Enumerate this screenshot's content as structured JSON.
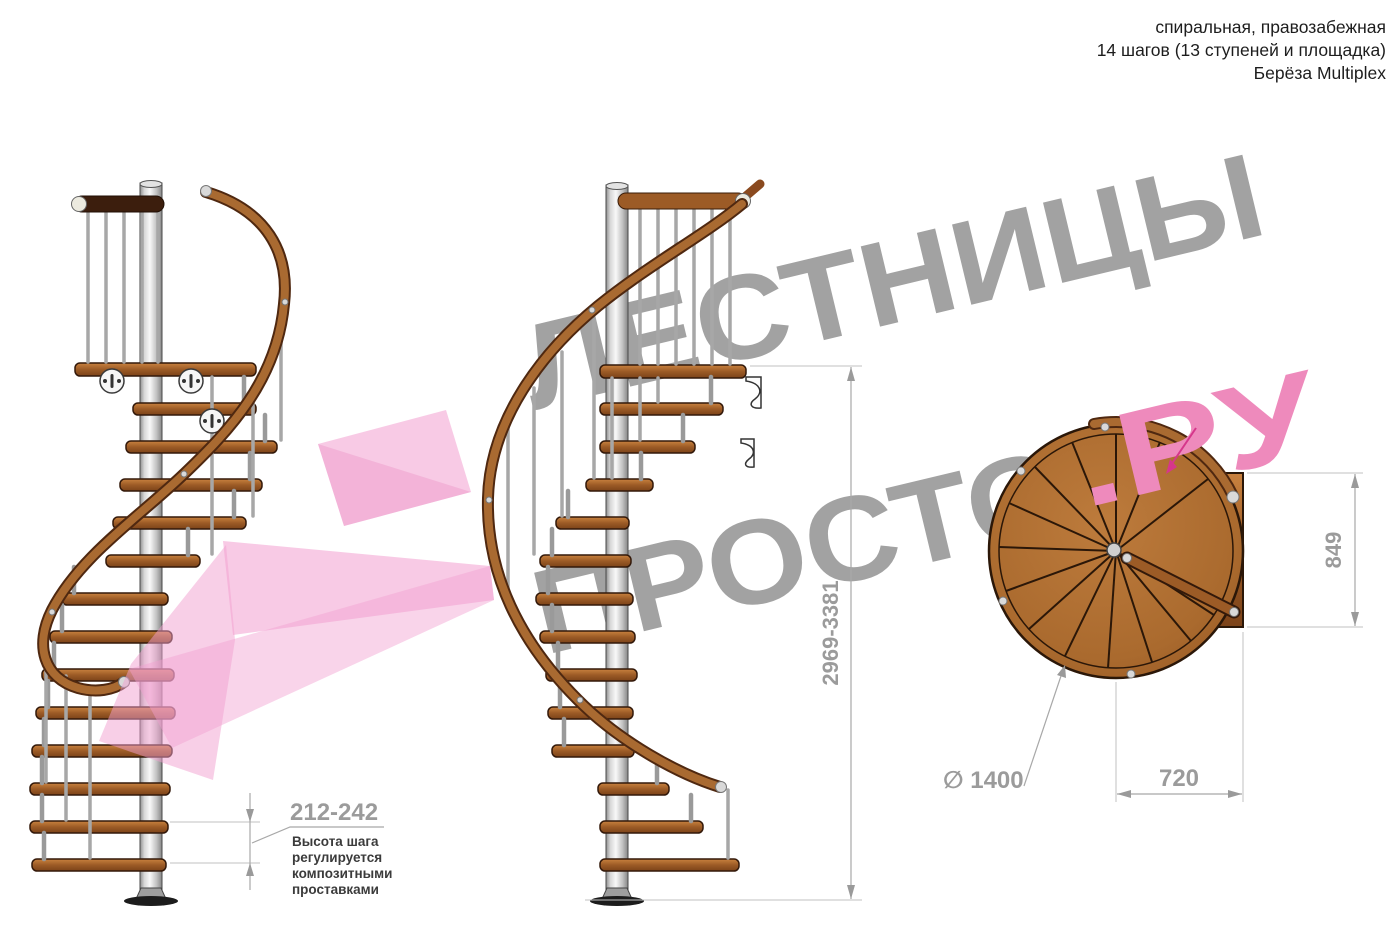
{
  "header": {
    "line1": "спиральная, правозабежная",
    "line2": "14 шагов (13 ступеней и площадка)",
    "line3": "Берёза Multiplex"
  },
  "watermark": {
    "line1": "ЛЕСТНИЦЫ",
    "line2_gray": "ПРОСТО",
    "line2_pink": ".РУ"
  },
  "dimensions": {
    "total_height": "2969-3381",
    "step_height": "212-242",
    "step_note_line1": "Высота шага",
    "step_note_line2": "регулируется",
    "step_note_line3": "композитными",
    "step_note_line4": "проставками",
    "plan_width": "720",
    "plan_depth": "849",
    "diameter_label": "∅ 1400"
  },
  "colors": {
    "watermark_gray": "#a2a2a2",
    "watermark_pink": "#ee8abc",
    "arrow_pink": "#f29fd0",
    "wood": "#a8622b",
    "steel": "#cfcfcf",
    "dimension_gray": "#9b9b9b"
  }
}
